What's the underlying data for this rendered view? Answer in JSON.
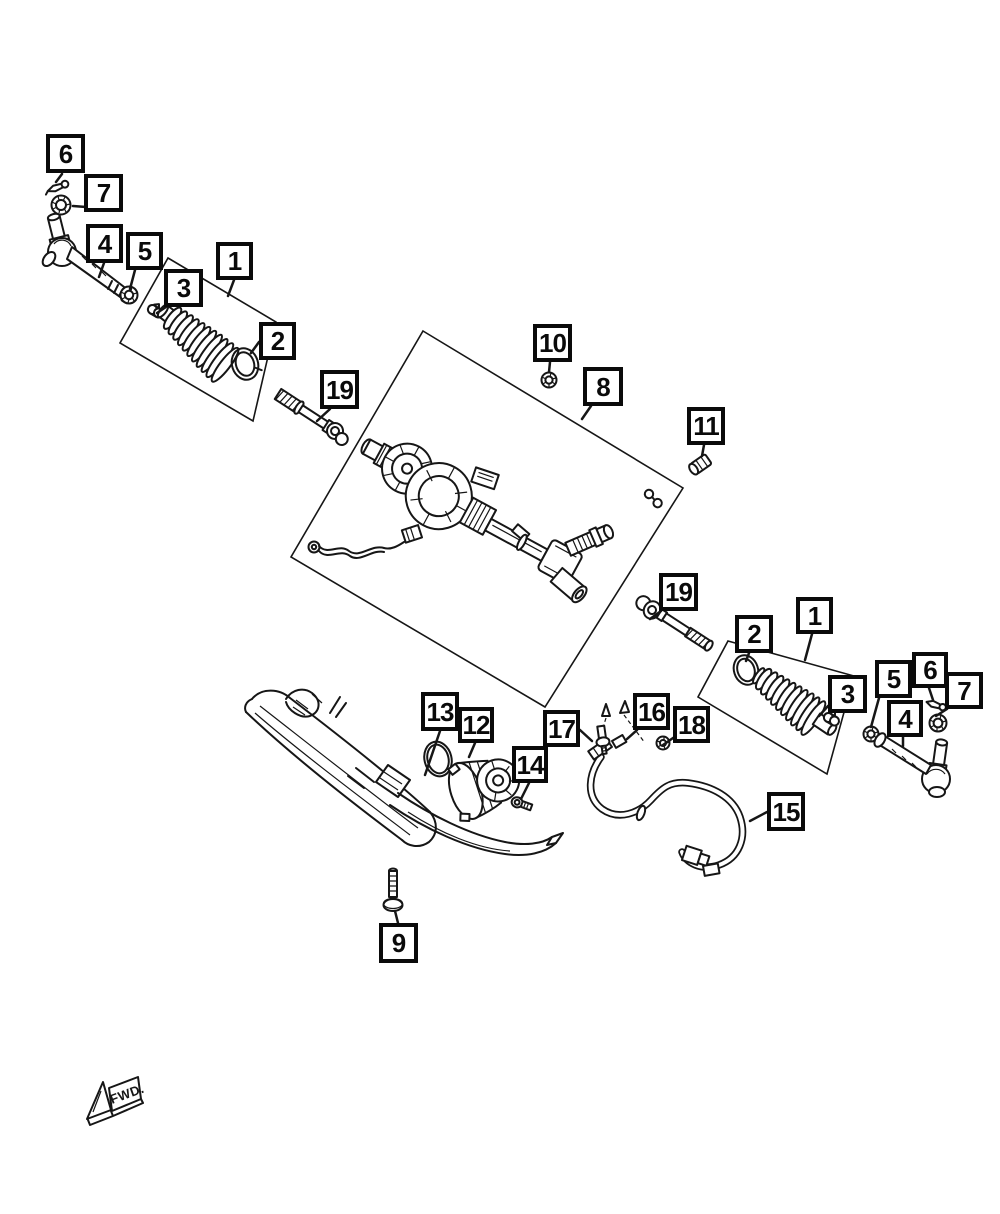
{
  "page": {
    "width": 1000,
    "height": 1214,
    "background_color": "#ffffff",
    "line_color": "#161616",
    "callout_border_color": "#0a0a0a"
  },
  "diagram": {
    "kind": "exploded-parts-diagram",
    "fwd_marker": {
      "label": "FWD."
    },
    "callouts": [
      {
        "id": "6-left",
        "label": "6",
        "x": 46,
        "y": 134,
        "w": 39,
        "h": 39,
        "leader": [
          62,
          174,
          56,
          182
        ]
      },
      {
        "id": "7-left",
        "label": "7",
        "x": 84,
        "y": 174,
        "w": 39,
        "h": 38,
        "leader": [
          86,
          207,
          73,
          206
        ]
      },
      {
        "id": "4-left",
        "label": "4",
        "x": 86,
        "y": 224,
        "w": 37,
        "h": 39,
        "leader": [
          104,
          263,
          99,
          277
        ]
      },
      {
        "id": "5-left",
        "label": "5",
        "x": 126,
        "y": 232,
        "w": 37,
        "h": 38,
        "leader": [
          135,
          270,
          130,
          289
        ]
      },
      {
        "id": "3-left",
        "label": "3",
        "x": 164,
        "y": 269,
        "w": 39,
        "h": 38,
        "leader": [
          166,
          307,
          157,
          313
        ]
      },
      {
        "id": "1-left",
        "label": "1",
        "x": 216,
        "y": 242,
        "w": 37,
        "h": 38,
        "leader": [
          234,
          280,
          228,
          296
        ]
      },
      {
        "id": "2-left",
        "label": "2",
        "x": 259,
        "y": 322,
        "w": 37,
        "h": 38,
        "leader": [
          259,
          342,
          251,
          353
        ]
      },
      {
        "id": "19-left",
        "label": "19",
        "x": 320,
        "y": 370,
        "w": 39,
        "h": 39,
        "leader": [
          330,
          409,
          317,
          421
        ]
      },
      {
        "id": "10",
        "label": "10",
        "x": 533,
        "y": 324,
        "w": 39,
        "h": 38,
        "leader": [
          550,
          362,
          549,
          372
        ]
      },
      {
        "id": "8",
        "label": "8",
        "x": 583,
        "y": 367,
        "w": 40,
        "h": 39,
        "leader": [
          591,
          406,
          582,
          419
        ]
      },
      {
        "id": "11",
        "label": "11",
        "x": 687,
        "y": 407,
        "w": 38,
        "h": 38,
        "leader": [
          704,
          445,
          702,
          456
        ]
      },
      {
        "id": "19-right",
        "label": "19",
        "x": 659,
        "y": 573,
        "w": 39,
        "h": 38,
        "leader": [
          661,
          611,
          650,
          619
        ]
      },
      {
        "id": "2-right",
        "label": "2",
        "x": 735,
        "y": 615,
        "w": 38,
        "h": 38,
        "leader": [
          749,
          653,
          746,
          661
        ]
      },
      {
        "id": "1-right",
        "label": "1",
        "x": 796,
        "y": 597,
        "w": 37,
        "h": 37,
        "leader": [
          812,
          634,
          805,
          660
        ]
      },
      {
        "id": "3-right",
        "label": "3",
        "x": 828,
        "y": 675,
        "w": 39,
        "h": 38,
        "leader": [
          828,
          706,
          819,
          716
        ]
      },
      {
        "id": "5-right",
        "label": "5",
        "x": 875,
        "y": 660,
        "w": 37,
        "h": 38,
        "leader": [
          879,
          698,
          871,
          727
        ]
      },
      {
        "id": "6-right",
        "label": "6",
        "x": 912,
        "y": 652,
        "w": 36,
        "h": 36,
        "leader": [
          929,
          688,
          933,
          700
        ]
      },
      {
        "id": "7-right",
        "label": "7",
        "x": 945,
        "y": 672,
        "w": 38,
        "h": 37,
        "leader": [
          947,
          709,
          936,
          716
        ]
      },
      {
        "id": "4-right",
        "label": "4",
        "x": 887,
        "y": 700,
        "w": 36,
        "h": 37,
        "leader": [
          903,
          737,
          903,
          746
        ]
      },
      {
        "id": "13",
        "label": "13",
        "x": 421,
        "y": 692,
        "w": 38,
        "h": 39,
        "leader": [
          440,
          731,
          425,
          775
        ]
      },
      {
        "id": "12",
        "label": "12",
        "x": 458,
        "y": 707,
        "w": 36,
        "h": 36,
        "leader": [
          475,
          743,
          469,
          757
        ]
      },
      {
        "id": "17",
        "label": "17",
        "x": 543,
        "y": 710,
        "w": 37,
        "h": 37,
        "leader": [
          580,
          730,
          592,
          741
        ]
      },
      {
        "id": "14",
        "label": "14",
        "x": 512,
        "y": 746,
        "w": 36,
        "h": 37,
        "leader": [
          529,
          783,
          521,
          799
        ]
      },
      {
        "id": "16",
        "label": "16",
        "x": 633,
        "y": 693,
        "w": 37,
        "h": 37,
        "leader": [
          637,
          730,
          627,
          739
        ]
      },
      {
        "id": "18",
        "label": "18",
        "x": 673,
        "y": 706,
        "w": 37,
        "h": 37,
        "leader": [
          673,
          738,
          663,
          745
        ]
      },
      {
        "id": "15",
        "label": "15",
        "x": 767,
        "y": 792,
        "w": 38,
        "h": 39,
        "leader": [
          767,
          812,
          750,
          821
        ]
      },
      {
        "id": "9",
        "label": "9",
        "x": 379,
        "y": 923,
        "w": 39,
        "h": 40,
        "leader": [
          398,
          923,
          395,
          911
        ]
      }
    ],
    "group_outlines": [
      {
        "name": "steering-gear-group-outline",
        "points": "423,331 683,488 545,707 291,557"
      },
      {
        "name": "boot-kit-left-outline",
        "points": "168,258 276,322 253,421 120,343"
      },
      {
        "name": "boot-kit-right-outline",
        "points": "728,641 854,676 827,774 698,697"
      }
    ]
  }
}
